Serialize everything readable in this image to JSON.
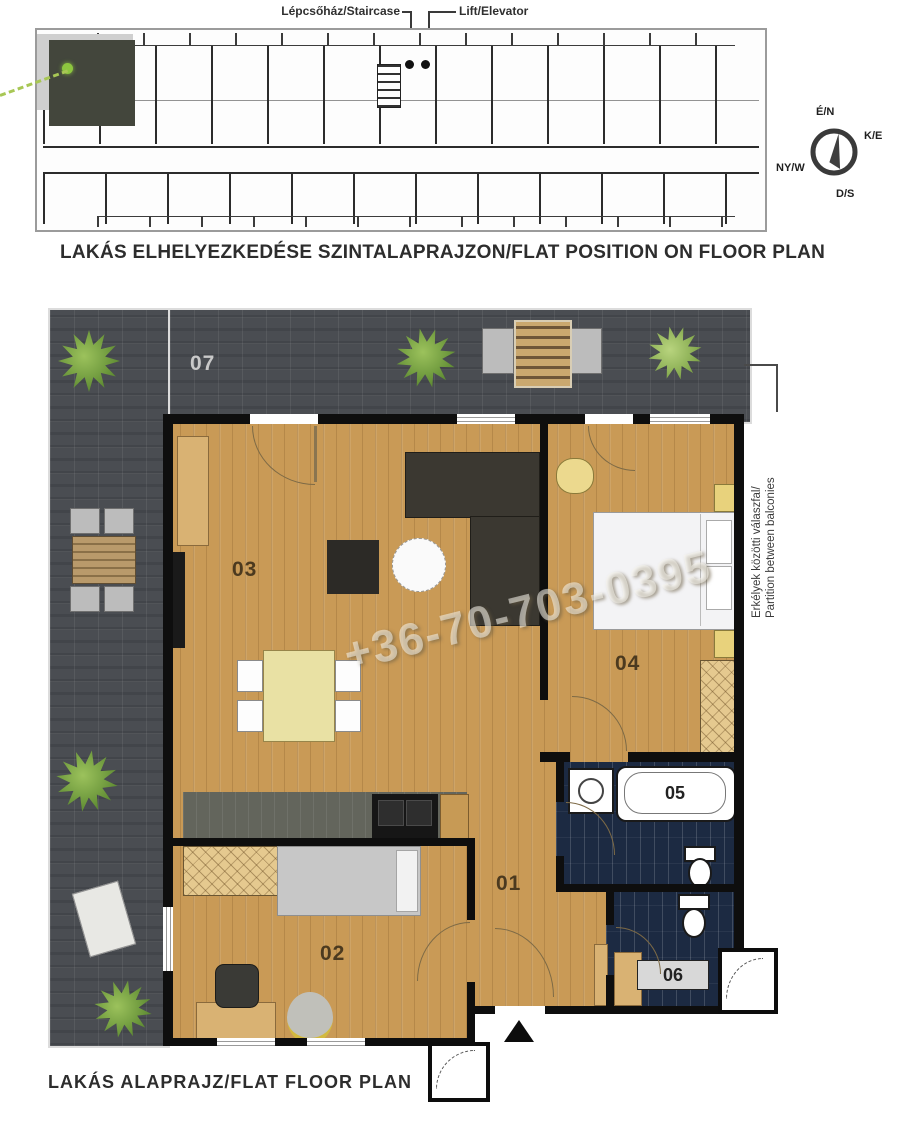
{
  "overview": {
    "caption": "LAKÁS ELHELYEZKEDÉSE SZINTALAPRAJZON/FLAT POSITION ON FLOOR PLAN",
    "labels": {
      "staircase": "Lépcsőház/Staircase",
      "elevator": "Lift/Elevator"
    },
    "compass": {
      "north": "É/N",
      "east": "K/E",
      "south": "D/S",
      "west": "NY/W"
    }
  },
  "flat": {
    "caption": "LAKÁS ALAPRAJZ/FLAT FLOOR PLAN",
    "watermark": "+36-70-703-0395",
    "partition_note": {
      "line1": "Erkélyek közötti válaszfal/",
      "line2": "Partition between balconies"
    },
    "rooms": {
      "r01": "01",
      "r02": "02",
      "r03": "03",
      "r04": "04",
      "r05": "05",
      "r06": "06",
      "r07": "07"
    }
  },
  "colors": {
    "terrace_tile": "#4a4d52",
    "wood_floor": "#c99a56",
    "wall": "#0e0e0e",
    "bathroom_tile": "#1c2a42",
    "highlighted_flat": "#43463c",
    "accent_green": "#8dc63f"
  }
}
